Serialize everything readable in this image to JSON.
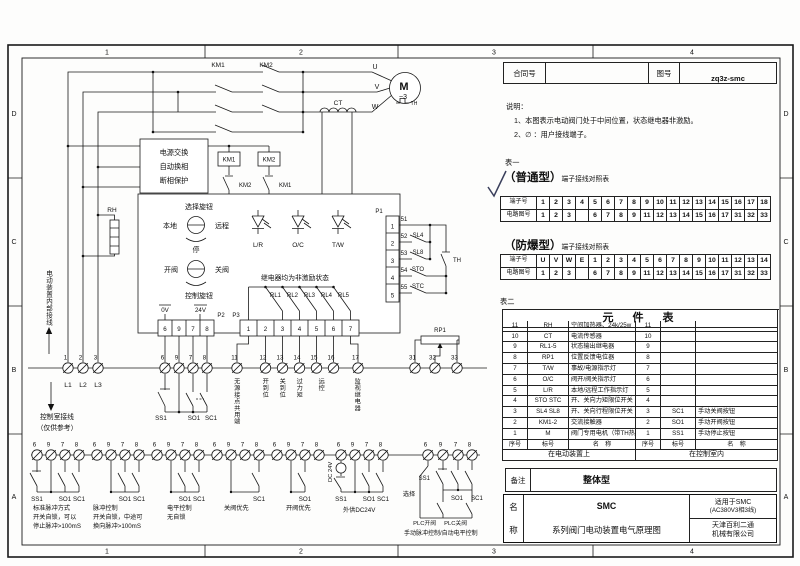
{
  "sheet": {
    "zone_numbers": [
      "1",
      "2",
      "3",
      "4"
    ],
    "zone_letters": [
      "D",
      "C",
      "B",
      "A"
    ]
  },
  "title_bar": {
    "contract_label": "合同号",
    "contract_value": "",
    "drawing_label": "图号",
    "drawing_value": "zq3z-smc"
  },
  "notes": {
    "heading": "说明：",
    "item1": "1、本图表示电动阀门处于中间位置，状态继电器非激励。",
    "item2": "2、∅ ：用户接线端子。"
  },
  "table1": {
    "caption": "表一",
    "normal_title": "（普通型）",
    "normal_subtitle": "端子接线对照表",
    "exp_title": "（防爆型）",
    "exp_subtitle": "端子接线对照表",
    "terminal_label": "端子号",
    "circuit_label": "电路图号",
    "normal_terminals": [
      "1",
      "2",
      "3",
      "4",
      "5",
      "6",
      "7",
      "8",
      "9",
      "10",
      "11",
      "12",
      "13",
      "14",
      "15",
      "16",
      "17",
      "18"
    ],
    "normal_circuits": [
      "1",
      "2",
      "3",
      "",
      "6",
      "7",
      "8",
      "9",
      "11",
      "12",
      "13",
      "14",
      "15",
      "16",
      "17",
      "31",
      "32",
      "33"
    ],
    "exp_terminals": [
      "U",
      "V",
      "W",
      "E",
      "1",
      "2",
      "3",
      "4",
      "5",
      "6",
      "7",
      "8",
      "9",
      "10",
      "11",
      "12",
      "13",
      "14"
    ],
    "exp_circuits": [
      "1",
      "2",
      "3",
      "",
      "6",
      "7",
      "8",
      "9",
      "11",
      "12",
      "13",
      "14",
      "15",
      "16",
      "17",
      "31",
      "32",
      "33"
    ]
  },
  "table2": {
    "caption": "表二",
    "title": "元　件　表",
    "col_headers": [
      "序号",
      "标号",
      "名　称",
      "序号",
      "标号",
      "名　称"
    ],
    "left_footer": "在电动装置上",
    "right_footer": "在控制室内",
    "rows": [
      {
        "l_no": "11",
        "l_tag": "RH",
        "l_name": "空间加热器、24k/25w",
        "r_no": "11",
        "r_tag": "",
        "r_name": ""
      },
      {
        "l_no": "10",
        "l_tag": "CT",
        "l_name": "电流传感器",
        "r_no": "10",
        "r_tag": "",
        "r_name": ""
      },
      {
        "l_no": "9",
        "l_tag": "RL1-5",
        "l_name": "状态输出继电器",
        "r_no": "9",
        "r_tag": "",
        "r_name": ""
      },
      {
        "l_no": "8",
        "l_tag": "RP1",
        "l_name": "位置反馈电位器",
        "r_no": "8",
        "r_tag": "",
        "r_name": ""
      },
      {
        "l_no": "7",
        "l_tag": "T/W",
        "l_name": "事故/电源指示灯",
        "r_no": "7",
        "r_tag": "",
        "r_name": ""
      },
      {
        "l_no": "6",
        "l_tag": "O/C",
        "l_name": "阀开/阀关指示灯",
        "r_no": "6",
        "r_tag": "",
        "r_name": ""
      },
      {
        "l_no": "5",
        "l_tag": "L/R",
        "l_name": "本地/远程工作指示灯",
        "r_no": "5",
        "r_tag": "",
        "r_name": ""
      },
      {
        "l_no": "4",
        "l_tag": "STO STC",
        "l_name": "开、关向力矩限位开关",
        "r_no": "4",
        "r_tag": "",
        "r_name": ""
      },
      {
        "l_no": "3",
        "l_tag": "SL4 SL8",
        "l_name": "开、关向行程限位开关",
        "r_no": "3",
        "r_tag": "SC1",
        "r_name": "手动关阀按钮"
      },
      {
        "l_no": "2",
        "l_tag": "KM1-2",
        "l_name": "交流接触器",
        "r_no": "2",
        "r_tag": "SO1",
        "r_name": "手动开阀按钮"
      },
      {
        "l_no": "1",
        "l_tag": "M",
        "l_name": "阀门专用电机（带TH热元件）",
        "r_no": "1",
        "r_tag": "SS1",
        "r_name": "手动停止按钮"
      }
    ]
  },
  "remark": {
    "label": "备注",
    "value": "整体型"
  },
  "name_block": {
    "label_top": "名",
    "label_bottom": "称",
    "line1": "SMC",
    "line2": "系列阀门电动装置电气原理图",
    "apply1": "适用于SMC",
    "apply2": "(AC380V3相3线)",
    "company1": "天津百利二通",
    "company2": "机械有限公司"
  },
  "schematic": {
    "km1": "KM1",
    "km2": "KM2",
    "u": "U",
    "v": "V",
    "w": "W",
    "motor": "M",
    "motor_phase": "~3",
    "motor_th": "TH",
    "ct": "CT",
    "rh": "RH",
    "prot1": "电源交换",
    "prot2": "自动换相",
    "prot3": "断相保护",
    "coil1": "KM1",
    "coil2": "KM2",
    "interlock1": "KM2",
    "interlock2": "KM1",
    "knob1_title": "选择旋钮",
    "knob1_left": "本地",
    "knob1_right": "远程",
    "knob1_stop": "停",
    "knob2_left": "开阀",
    "knob2_right": "关阀",
    "knob2_title": "控制旋钮",
    "led1": "L/R",
    "led2": "O/C",
    "led3": "T/W",
    "relay_note": "继电器均为非激励状态",
    "rl": [
      "RL1",
      "RL2",
      "RL3",
      "RL4",
      "RL5"
    ],
    "p1": "P1",
    "p2": "P2",
    "p3": "P3",
    "p1_cells": [
      "1",
      "2",
      "3",
      "4",
      "5"
    ],
    "p2_cells": [
      "6",
      "9",
      "7",
      "8"
    ],
    "p3_cells": [
      "1",
      "2",
      "3",
      "4",
      "5",
      "6",
      "7"
    ],
    "v0": "0V",
    "v24": "24V",
    "wire_nums": [
      "51",
      "52",
      "53",
      "54",
      "55"
    ],
    "sw_labels": [
      "SL4",
      "SL8",
      "STO",
      "STC"
    ],
    "th": "TH",
    "rp1": "RP1",
    "left_note": "电动装置内部接线",
    "ctrl_note1": "控制室接线",
    "ctrl_note2": "（仅供参考）",
    "phase_nums": [
      "1",
      "2",
      "3"
    ],
    "phase_labels": [
      "L1",
      "L2",
      "L3"
    ],
    "ctrl_terms": [
      "6",
      "9",
      "7",
      "8"
    ],
    "sig_terms": [
      "11",
      "12",
      "13",
      "14",
      "15",
      "16",
      "17"
    ],
    "sig_labels": [
      "无源接点共用端",
      "开到位",
      "关到位",
      "过力矩",
      "远控",
      "监视继电器"
    ],
    "pot_terms": [
      "31",
      "32",
      "33"
    ],
    "main_buttons": [
      "SS1",
      "SO1",
      "SC1"
    ],
    "dc_label": "DC 24V",
    "sel_label": "选择",
    "plc_open": "PLC开阀",
    "plc_close": "PLC关阀",
    "groups": [
      {
        "terms": [
          "6",
          "9",
          "7",
          "8"
        ],
        "buttons": [
          "SS1",
          "SO1",
          "SC1"
        ],
        "caption": [
          "标准脉冲方式",
          "开关自锁，可以",
          "停止脉冲>100mS"
        ]
      },
      {
        "terms": [
          "6",
          "9",
          "7",
          "8"
        ],
        "buttons": [
          "SO1",
          "SC1"
        ],
        "caption": [
          "脉冲控制",
          "开关自锁，中途可",
          "换向脉冲>100mS"
        ]
      },
      {
        "terms": [
          "6",
          "9",
          "7",
          "8"
        ],
        "buttons": [
          "SO1",
          "SC1"
        ],
        "caption": [
          "电平控制",
          "无自锁"
        ]
      },
      {
        "terms": [
          "6",
          "9",
          "7",
          "8"
        ],
        "buttons": [
          "SC1"
        ],
        "caption": [
          "关阀优先"
        ]
      },
      {
        "terms": [
          "6",
          "9",
          "7",
          "8"
        ],
        "buttons": [
          "SO1"
        ],
        "caption": [
          "开阀优先"
        ]
      },
      {
        "terms": [
          "6",
          "9",
          "7",
          "8"
        ],
        "buttons": [
          "SS1",
          "SO1",
          "SC1"
        ],
        "caption": [
          "外供DC24V"
        ]
      },
      {
        "terms": [
          "6",
          "9",
          "7",
          "8"
        ],
        "buttons": [
          "SS1",
          "SO1",
          "SC1"
        ],
        "caption": [
          "手动脉冲控制/自动电平控制"
        ]
      }
    ]
  }
}
